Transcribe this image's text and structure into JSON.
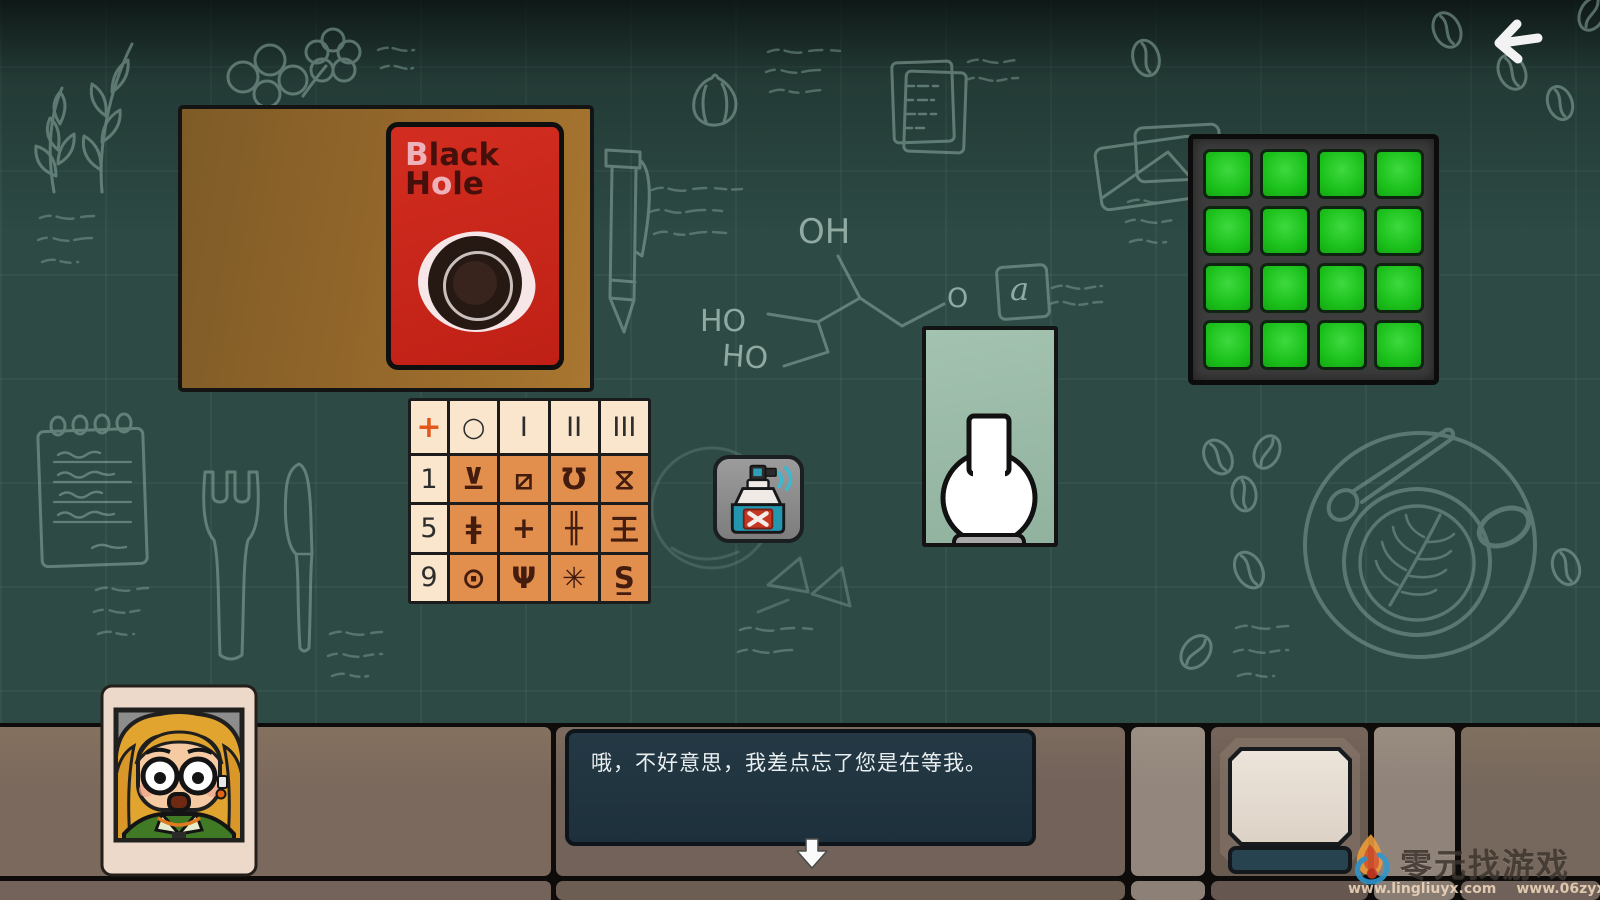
{
  "colors": {
    "chalkboard": "#2d4a44",
    "chalk": "#8fada5",
    "card_red": "#cd2a1e",
    "table_orange": "#e28f4e",
    "table_cream": "#f9e6cc",
    "grid_green": "#1ec21c",
    "spray_teal": "#2196ae",
    "dialogue_bg": "#203440"
  },
  "icons": {
    "back": "arrow-left",
    "continue": "arrow-down",
    "spray_label": "x-mark"
  },
  "blackhole_card": {
    "title_b": "B",
    "title_lack": "lack",
    "title_h": "H",
    "title_o": "o",
    "title_le": "le"
  },
  "symbol_table": {
    "corner": "+",
    "col_headers": [
      "○",
      "I",
      "II",
      "III"
    ],
    "rows": [
      {
        "label": "1",
        "cells": [
          "⊻",
          "⧄",
          "Ʊ",
          "⧖"
        ]
      },
      {
        "label": "5",
        "cells": [
          "ǂ",
          "+",
          "╫",
          "王"
        ]
      },
      {
        "label": "9",
        "cells": [
          "⊙",
          "Ψ",
          "✳",
          "S̲"
        ]
      }
    ]
  },
  "chalk_labels": {
    "oh": "OH",
    "ho1": "HO",
    "ho2": "HO",
    "o": "O",
    "a": "a"
  },
  "dialogue": {
    "text": "哦，不好意思，我差点忘了您是在等我。"
  },
  "watermark": {
    "title": "零元找游戏",
    "url_left": "www.lingliuyx.com",
    "url_right": "www.06zyx.com"
  }
}
